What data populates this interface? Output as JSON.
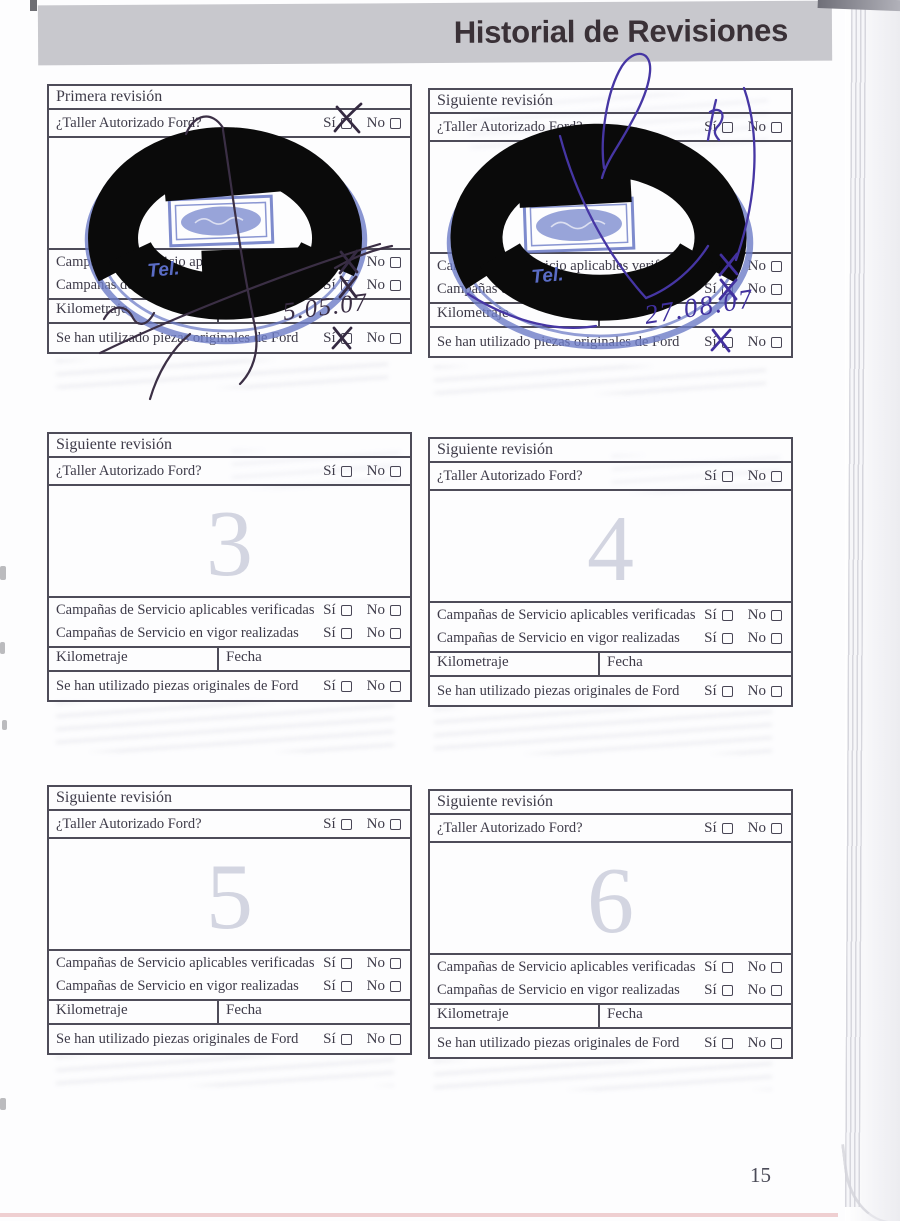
{
  "header": {
    "title": "Historial de Revisiones"
  },
  "page_number": "15",
  "labels": {
    "si": "Sí",
    "no": "No",
    "taller": "¿Taller Autorizado Ford?",
    "camp_aplicables": "Campañas de Servicio aplicables verificadas",
    "camp_vigor": "Campañas de Servicio en vigor realizadas",
    "kilometraje": "Kilometraje",
    "fecha": "Fecha",
    "piezas": "Se han utilizado piezas originales de Ford"
  },
  "boxes": [
    {
      "title": "Primera revisión",
      "watermark": "",
      "stamp": {
        "present": true,
        "tel_label": "Tel.",
        "fecha_handwritten": "5.05.07",
        "taller_si_checked": true,
        "camp_aplicables_si_checked": true,
        "camp_vigor_si_checked": true,
        "piezas_si_checked": true
      }
    },
    {
      "title": "Siguiente revisión",
      "watermark": "",
      "stamp": {
        "present": true,
        "tel_label": "Tel.",
        "fecha_handwritten": "27.08.07",
        "taller_si_checked": true,
        "camp_aplicables_si_checked": true,
        "camp_vigor_si_checked": true,
        "piezas_si_checked": true
      }
    },
    {
      "title": "Siguiente revisión",
      "watermark": "3",
      "stamp": {
        "present": false
      }
    },
    {
      "title": "Siguiente revisión",
      "watermark": "4",
      "stamp": {
        "present": false
      }
    },
    {
      "title": "Siguiente revisión",
      "watermark": "5",
      "stamp": {
        "present": false
      }
    },
    {
      "title": "Siguiente revisión",
      "watermark": "6",
      "stamp": {
        "present": false
      }
    }
  ],
  "colors": {
    "header_bar": "#c8c8cd",
    "stamp_blue": "#6d7cc7",
    "pen_dark": "#3b2f45",
    "pen_purple": "#4636a4",
    "watermark_gray": "#d3d5e1"
  }
}
